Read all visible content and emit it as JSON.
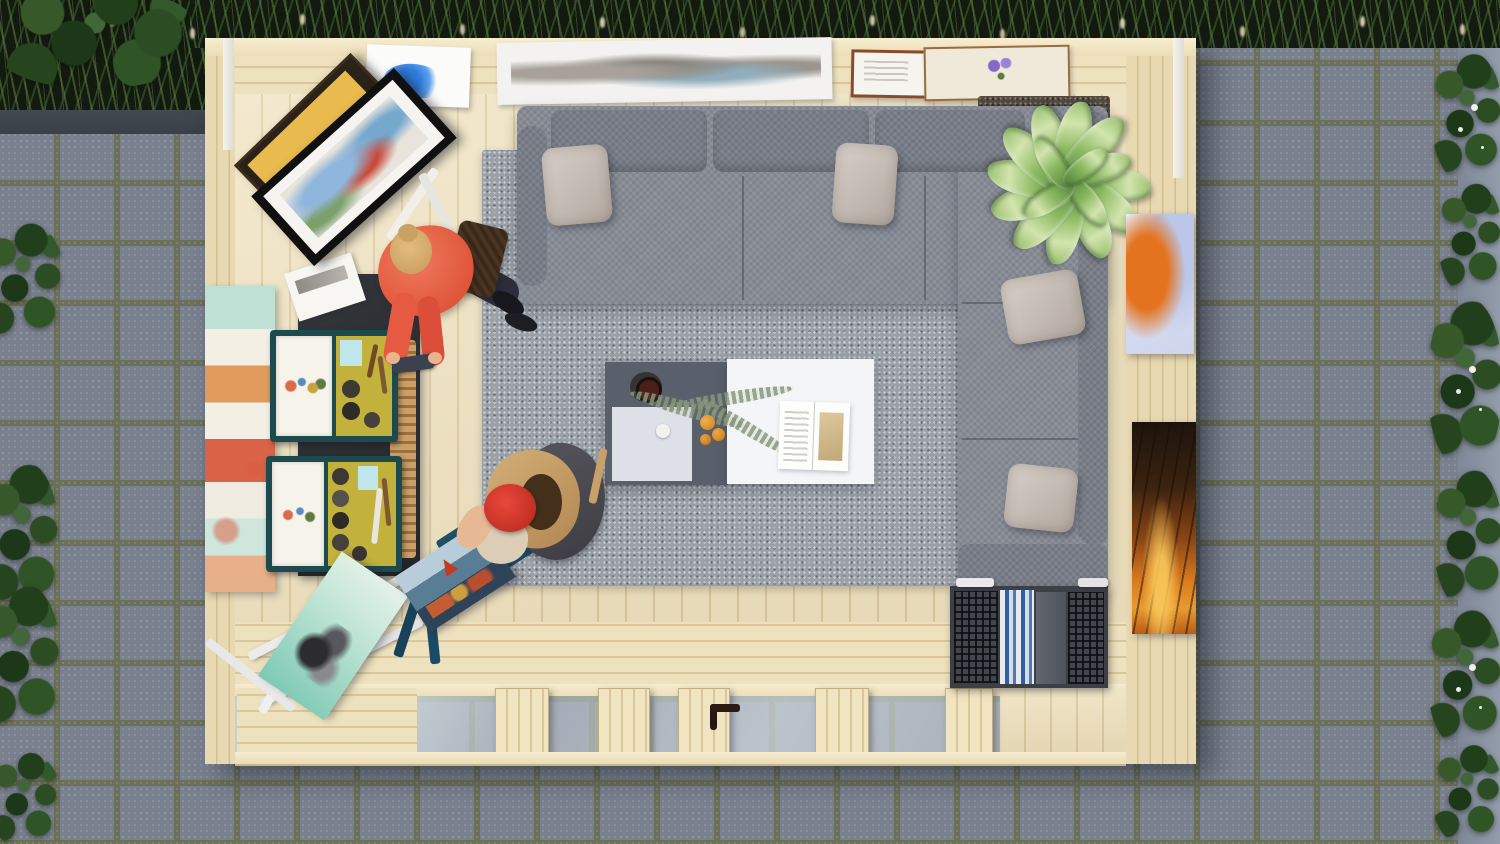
{
  "scene": {
    "title": "Top-down 3D render of a wooden garden studio with corner sofa, art easels and two people, surrounded by gray paving and ivy",
    "objects": {
      "pavers": "gray concrete paving slabs with mossy joints",
      "grass": "dark planter with ornamental grasses and seed heads",
      "ivy": "ivy climbing plants along the left and right edges",
      "cabin": "pine log garden cabin seen from directly above",
      "wall_prints": "art prints lying on the top wall ledge",
      "framed_paintings": "two framed paintings leaning on a black side table",
      "sofa": "gray fabric corner sofa",
      "pillows": "light gray throw pillows",
      "rug": "gray woven area rug",
      "corner_rug": "dark brown mat under the house plant",
      "plant": "dieffenbachia house plant in the corner",
      "coffee_table": "two-tone coffee table with dark gray and white tops",
      "coffee_cup": "black coffee cup on a round tray",
      "fern": "fern sprig lying across the table",
      "oranges": "small oranges on the table",
      "magazine": "open magazine on the white table top",
      "pastel_canvas": "pastel abstract canvas leaning on the left wall",
      "blossom_canvas": "orange blossom canvas on the right wall ledge",
      "sunset_canvas": "sunset forest canvas on the right wall ledge",
      "paint_cases": "open teal paint boxes with brushes and paint pots",
      "brush_holder": "wooden brush holder beside the paint boxes",
      "white_easel": "folded white easel with a teal flower canvas",
      "blue_easel": "blue easel holding a harbour painting",
      "magazine_rack": "perforated metal magazine rack with magazines",
      "glass_doors": "glass door band seen edge-on from above",
      "door_handle": "dark door handle",
      "woman_standing": "standing woman in a coral shirt with shoulder bag and phone",
      "woman_painting": "seated painter wearing a red beret and tan jacket"
    },
    "colors": {
      "paver": "#7a818e",
      "grout": "#6b7158",
      "pine": "#ecdfbb",
      "sofa_gray": "#868b95",
      "pillow": "#c9c0b9",
      "rug": "#9aa0a8",
      "table_dark": "#59606b",
      "table_white": "#f4f5f7",
      "teal_case": "#1c4a4e",
      "felt_yellow": "#c2b13a",
      "coral_shirt": "#e85a43",
      "beret_red": "#d8352a",
      "plant_green": "#7fae55",
      "sunset_orange": "#d97b1e",
      "blossom_orange": "#e4731f",
      "glass": "#ccd4d9",
      "ivy_green": "#2c4f24",
      "grass_green": "#4c6e35"
    }
  }
}
